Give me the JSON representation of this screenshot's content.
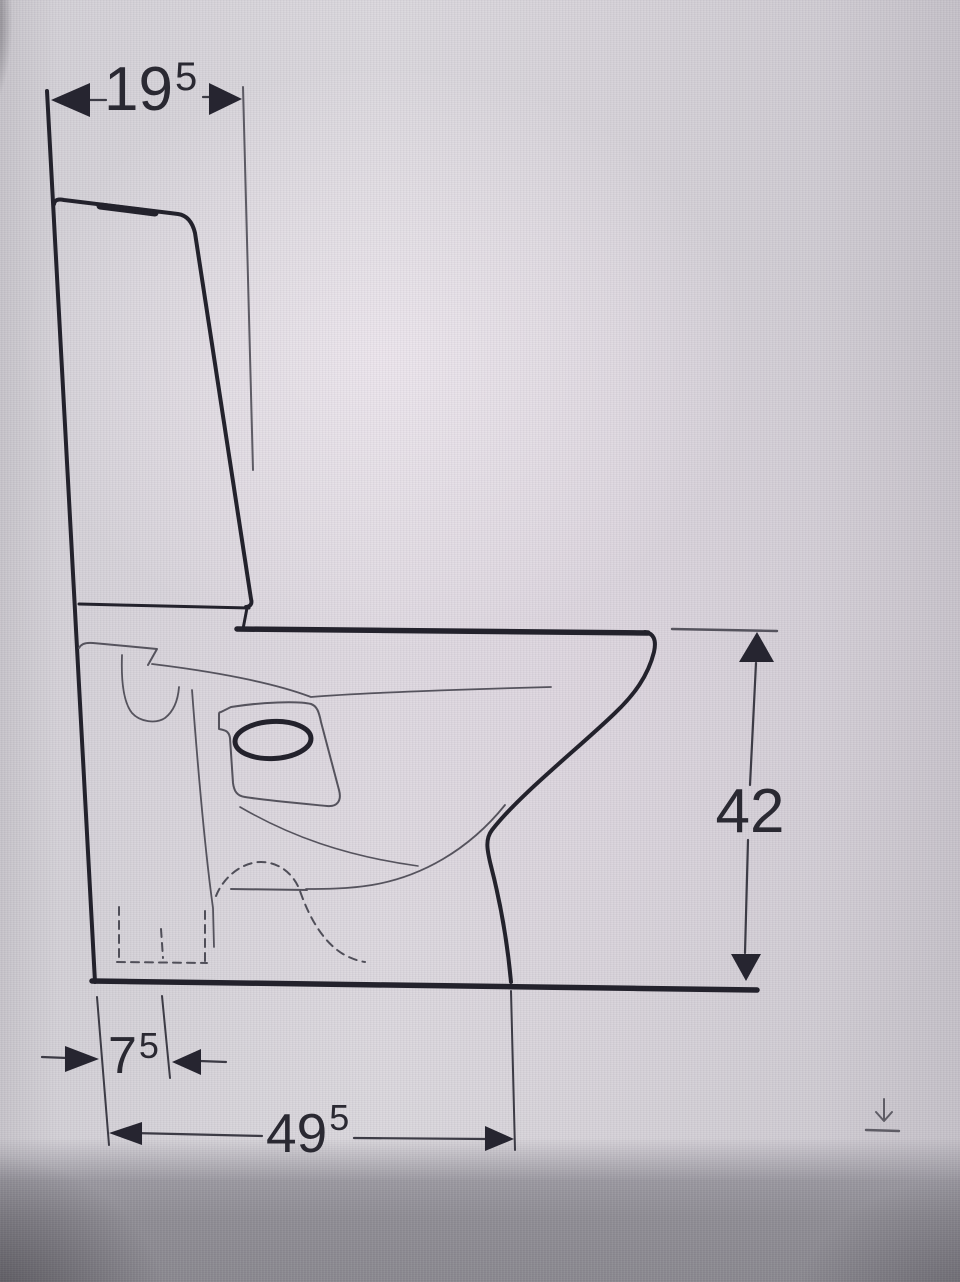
{
  "drawing": {
    "dimensions": {
      "top_width": {
        "value": "19",
        "sup": "5"
      },
      "height": {
        "value": "42",
        "sup": ""
      },
      "outlet_offset": {
        "value": "7",
        "sup": "5"
      },
      "depth": {
        "value": "49",
        "sup": "5"
      }
    },
    "colors": {
      "line_bold": "#23222c",
      "line_thin": "#55535d",
      "dimension_ink": "#262530",
      "background": "#d5d2d7",
      "background_bottom": "#8d8b92"
    },
    "icons": {
      "download": "download-icon"
    }
  }
}
